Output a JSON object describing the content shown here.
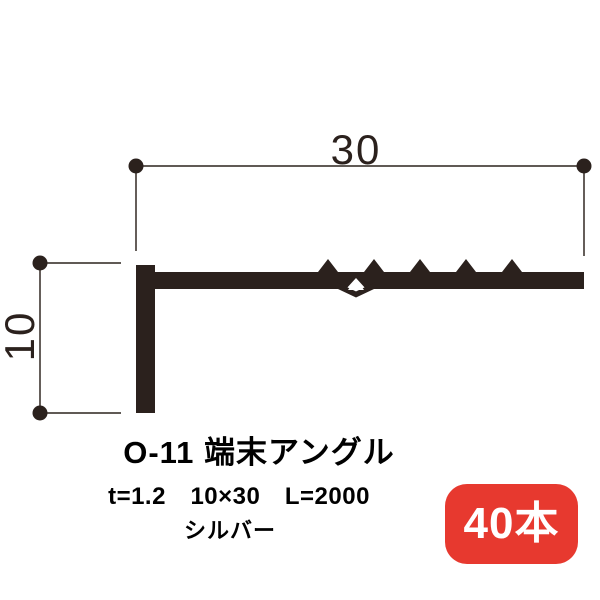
{
  "diagram": {
    "width_dimension_label": "30",
    "height_dimension_label": "10",
    "ink_color": "#2b211d",
    "dimension_line_color": "#4a423d"
  },
  "product": {
    "title": "O-11 端末アングル",
    "specs": "t=1.2　10×30　L=2000",
    "color_name": "シルバー",
    "quantity": "40本",
    "badge_background": "#e7392f",
    "badge_text_color": "#ffffff"
  }
}
